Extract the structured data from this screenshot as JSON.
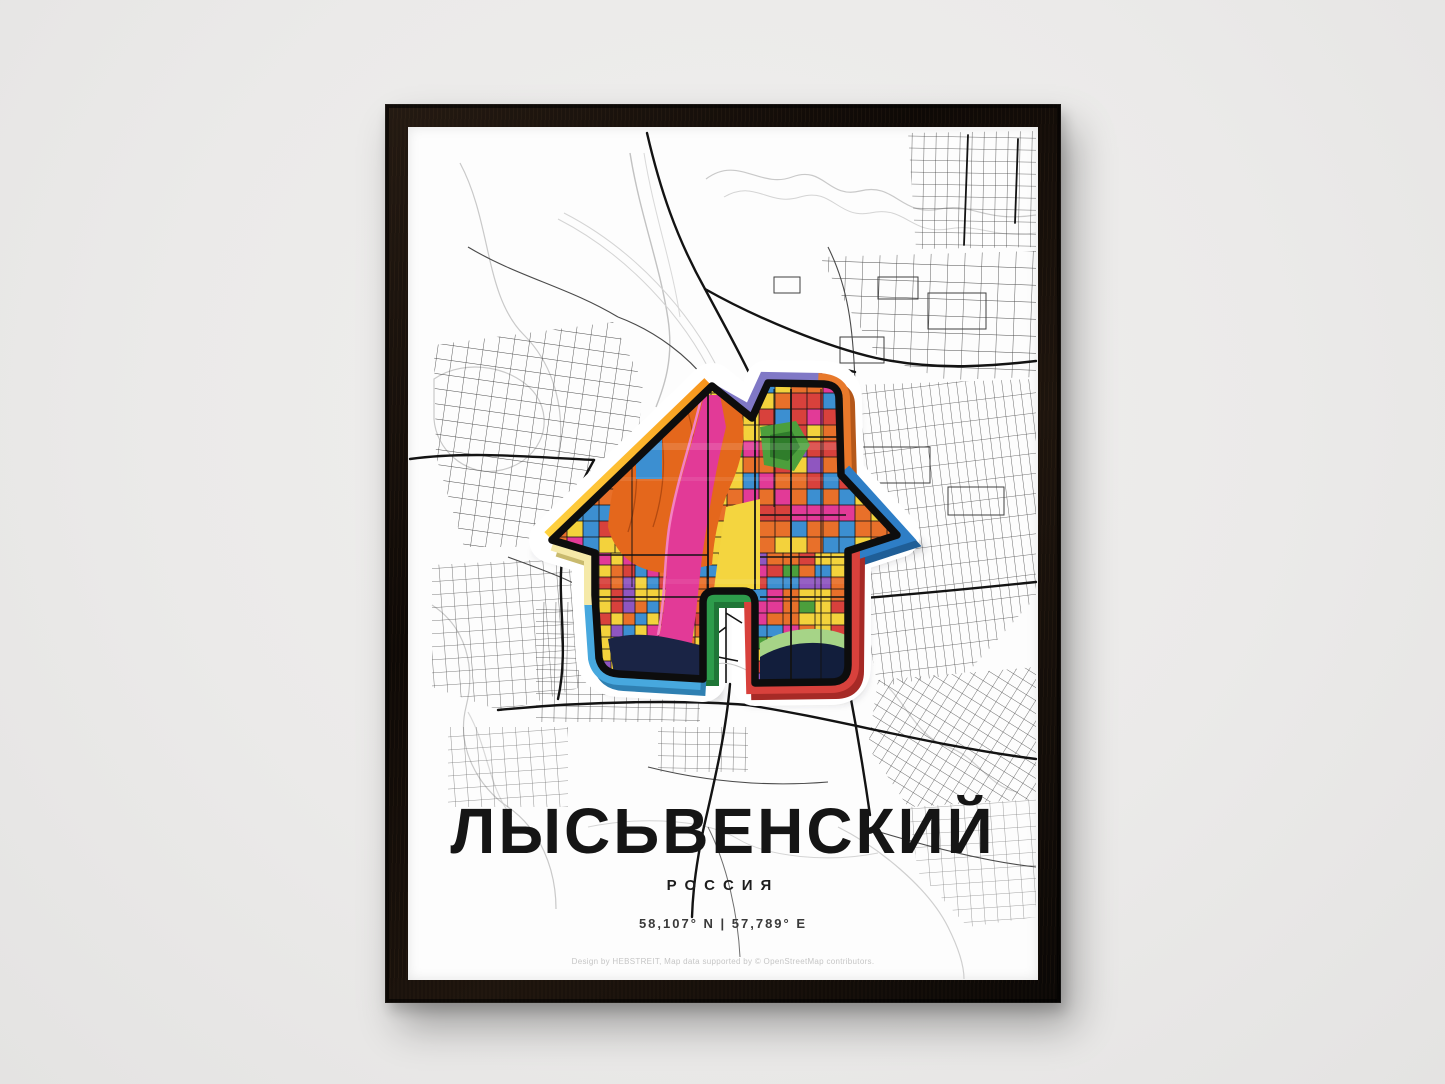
{
  "scene": {
    "wall_color": "#EBEAE9",
    "frame_color": "#150E09",
    "paper_color": "#FDFDFD"
  },
  "poster": {
    "title": "ЛЫСЬВЕНСКИЙ",
    "subtitle": "РОССИЯ",
    "coordinates": "58,107° N | 57,789° E",
    "credit": "Design by HEBSTREIT, Map data supported by © OpenStreetMap contributors.",
    "map_style": {
      "background": "#FFFFFF",
      "contour_color": "#C9C9C9",
      "street_color": "#4A4A4A",
      "main_road_color": "#141414"
    },
    "house": {
      "border_colors": {
        "roof_left_bottom": "#FFD23F",
        "roof_left_top": "#F7941D",
        "roof_notch": "#8078C6",
        "chimney_right": "#E8792B",
        "eave_right": "#2E7EC6",
        "wall_right_door": "#D8413C",
        "door_inner": "#2D9C4B",
        "wall_left_lower": "#47A8DE",
        "wall_left_upper": "#F5E9A8"
      },
      "palette": [
        "#E8702A",
        "#F3D23C",
        "#D8413C",
        "#3C8FD1",
        "#E23A97",
        "#8F56C0",
        "#4C9F3C"
      ]
    }
  }
}
